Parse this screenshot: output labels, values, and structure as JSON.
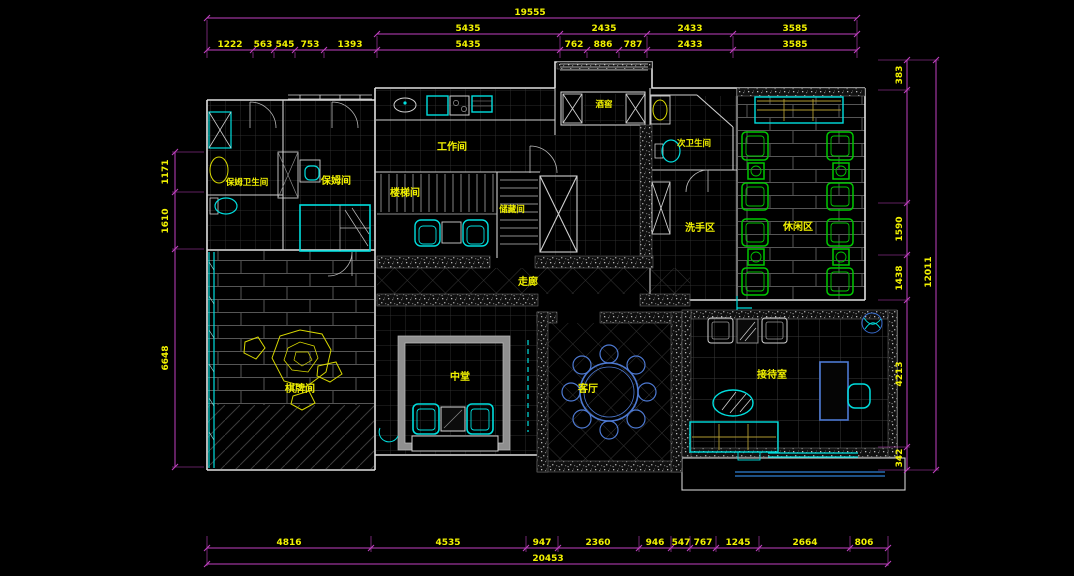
{
  "app": {
    "title": "CAD floor plan drawing"
  },
  "colors": {
    "background": "#000000",
    "dimension_line": "#bf40bf",
    "dimension_text": "#f2f200",
    "wall": "#e0e0e0",
    "fixture_cyan": "#00dede",
    "furniture_green": "#00c800",
    "furniture_blue": "#4d79d2",
    "sofa_tan": "#b09a30",
    "stone_yellow": "#d8d800"
  },
  "dims": {
    "top": {
      "overall": "19555",
      "row2": [
        "5435",
        "2435",
        "2433",
        "3585"
      ],
      "row3": [
        "1222",
        "563",
        "545",
        "753",
        "1393",
        "5435",
        "762",
        "886",
        "787",
        "2433",
        "3585"
      ]
    },
    "bottom": {
      "overall": "20453",
      "segments": [
        "4816",
        "4535",
        "947",
        "2360",
        "946",
        "547",
        "767",
        "1245",
        "2664",
        "806"
      ]
    },
    "left": {
      "segments": [
        "1171",
        "1610",
        "6648"
      ]
    },
    "right": {
      "overall": "12011",
      "segments": [
        "383",
        "1590",
        "1438",
        "4213",
        "342"
      ]
    }
  },
  "rooms": {
    "nanny_bathroom": "保姆卫生间",
    "nanny_room": "保姆间",
    "workroom": "工作间",
    "stairwell": "楼梯间",
    "storage": "储藏间",
    "wine_cellar": "酒窖",
    "second_bathroom": "次卫生间",
    "wash_area": "洗手区",
    "leisure_area": "休闲区",
    "corridor": "走廊",
    "chess_room": "棋牌间",
    "central_hall": "中堂",
    "living_room": "客厅",
    "reception_room": "接待室"
  }
}
